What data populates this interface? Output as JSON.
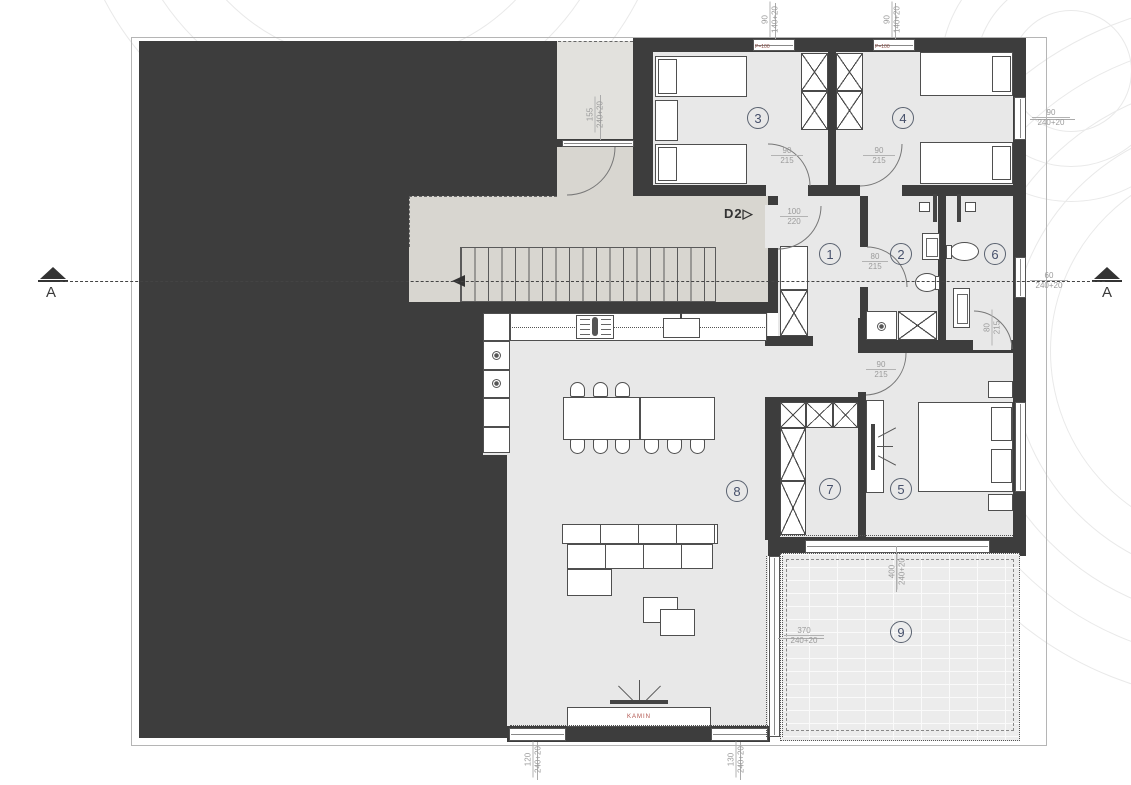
{
  "labels": {
    "section_marker": "A",
    "door_tag": "D2",
    "door_tag_arrow": "▷",
    "fireplace": "KAMIN",
    "parapet": "P=100"
  },
  "rooms": {
    "r1": "1",
    "r2": "2",
    "r3": "3",
    "r4": "4",
    "r5": "5",
    "r6": "6",
    "r7": "7",
    "r8": "8",
    "r9": "9"
  },
  "dims": {
    "win_top_1": {
      "a": "90",
      "b": "140+20"
    },
    "win_top_2": {
      "a": "90",
      "b": "140+20"
    },
    "win_right_room4": {
      "a": "90",
      "b": "240+20"
    },
    "win_right_room6": {
      "a": "60",
      "b": "240+20"
    },
    "win_entry": {
      "a": "155",
      "b": "240+20"
    },
    "win_bottom_left": {
      "a": "120",
      "b": "240+20"
    },
    "win_bottom_right": {
      "a": "130",
      "b": "240+20"
    },
    "terrace_width": {
      "a": "400",
      "b": "240+20"
    },
    "terrace_door": {
      "a": "370",
      "b": "240+20"
    },
    "door_room3": {
      "a": "90",
      "b": "215"
    },
    "door_room4": {
      "a": "90",
      "b": "215"
    },
    "door_entry_d2": {
      "a": "100",
      "b": "220"
    },
    "door_bath": {
      "a": "80",
      "b": "215"
    },
    "door_wc": {
      "a": "80",
      "b": "215"
    },
    "door_room5": {
      "a": "90",
      "b": "215"
    }
  },
  "colors": {
    "wall": "#3d3d3d",
    "room_fill": "#e8e8e8",
    "hall_fill": "#d8d6d0",
    "accent_red": "#b0524b",
    "dim_text": "#9b9b9b"
  }
}
